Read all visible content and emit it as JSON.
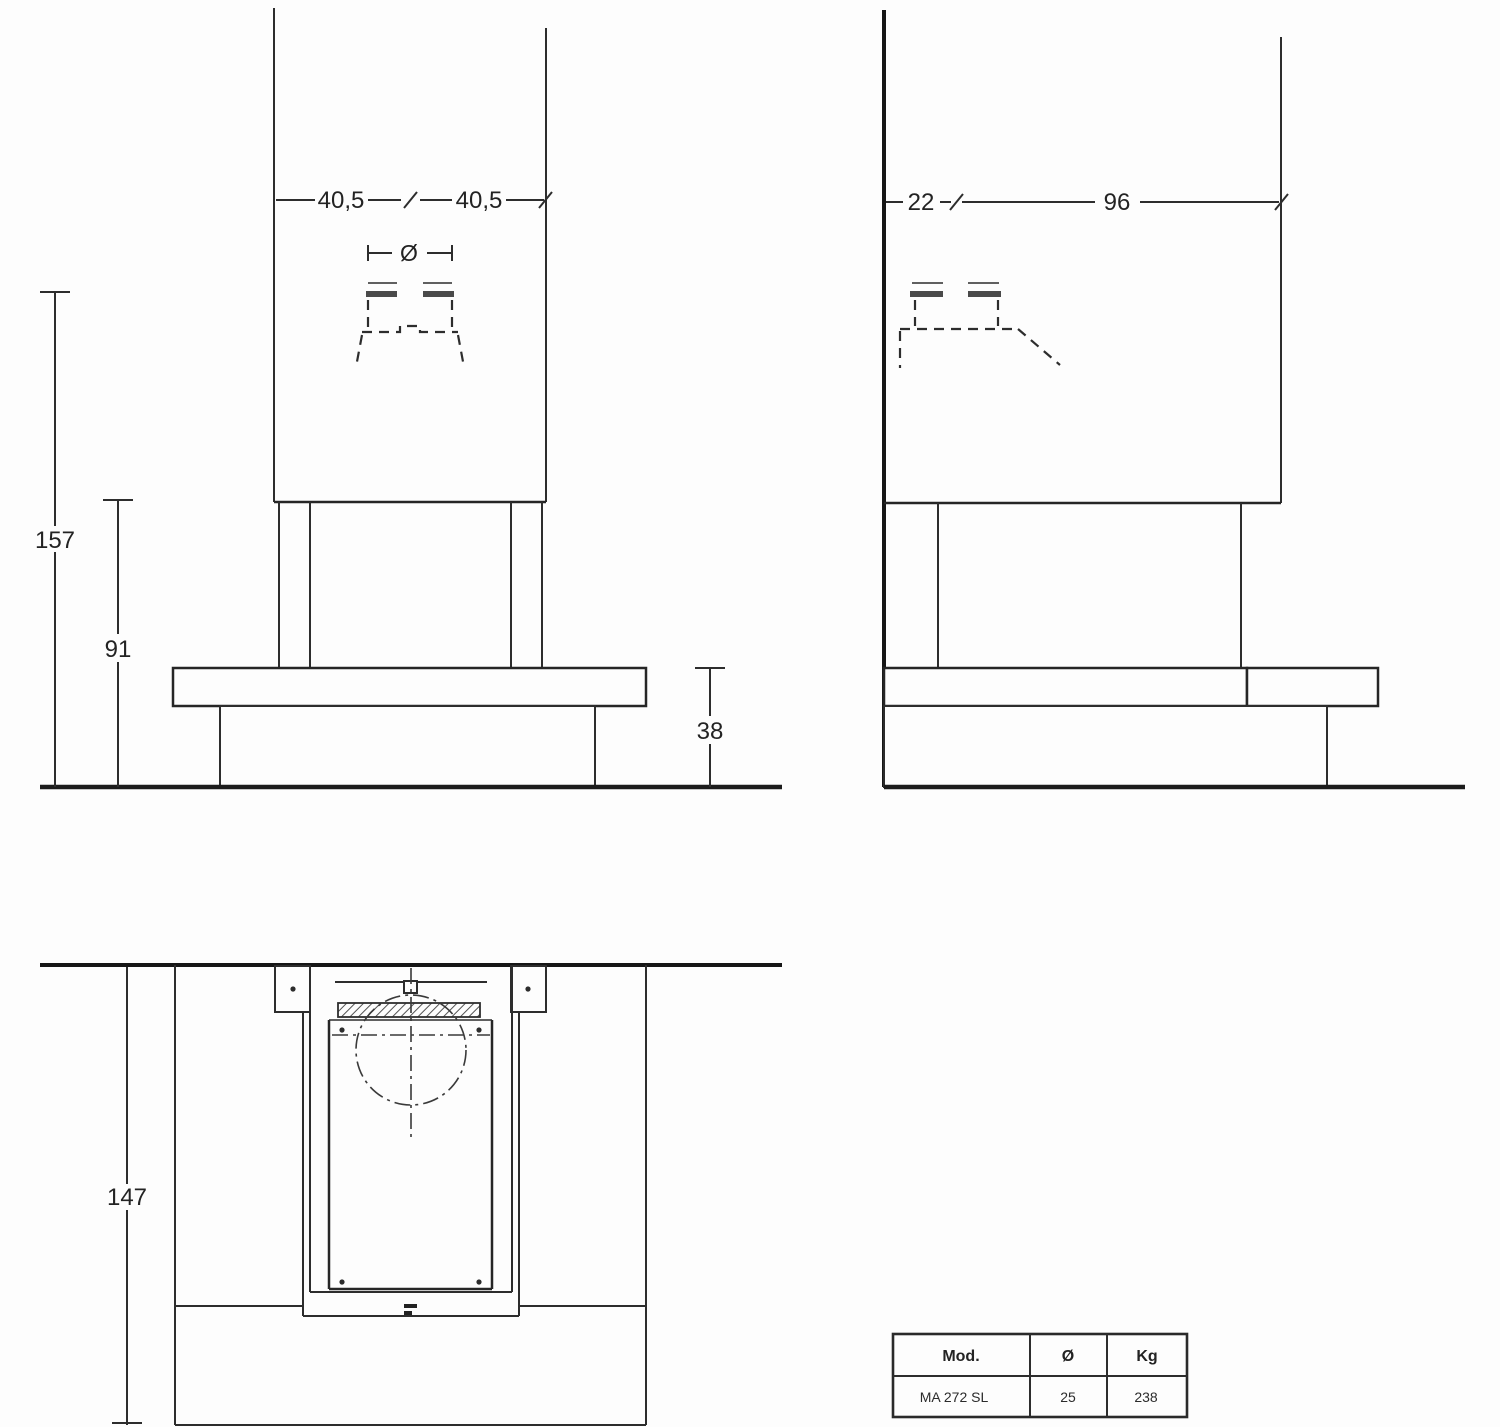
{
  "front_view": {
    "dim_width_left": "40,5",
    "dim_width_right": "40,5",
    "flue_symbol": "Ø",
    "dim_height_total": "157",
    "dim_height_hood": "91",
    "dim_height_hearth": "38"
  },
  "side_view": {
    "dim_depth_flue": "22",
    "dim_depth_total": "96"
  },
  "plan_view": {
    "dim_depth_total": "147"
  },
  "spec_table": {
    "col_mod": "Mod.",
    "col_diameter": "Ø",
    "col_weight": "Kg",
    "row_mod": "MA 272 SL",
    "row_diameter": "25",
    "row_weight": "238"
  }
}
